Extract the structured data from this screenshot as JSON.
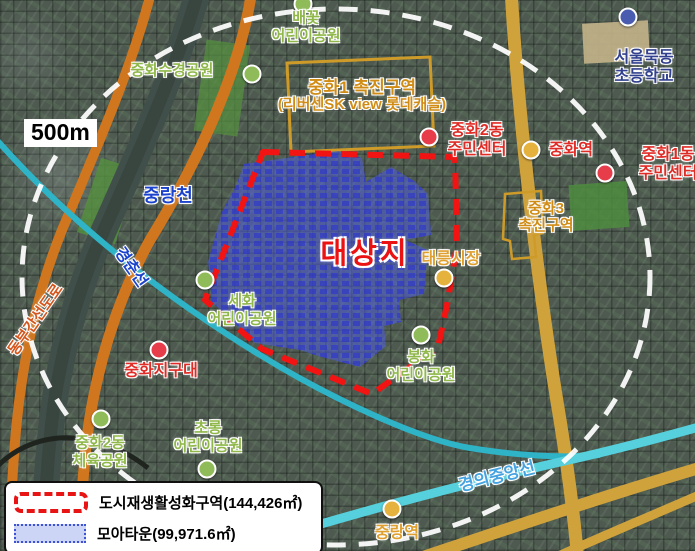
{
  "scale": {
    "label": "500m"
  },
  "site": {
    "label": "대상지"
  },
  "legend": {
    "items": [
      {
        "id": "regeneration-zone",
        "label": "도시재생활성화구역(144,426㎡)",
        "swatch": "red-dashed-outline"
      },
      {
        "id": "moa-town",
        "label": "모아타운(99,971.6㎡)",
        "swatch": "blue-filled"
      }
    ]
  },
  "zones": [
    {
      "id": "junghwa1-promotion-zone",
      "lines": [
        "중화1 촉진구역",
        "(리버센SK view 롯데캐슬)"
      ],
      "x": 362,
      "y": 96,
      "sizes": [
        17,
        15
      ]
    },
    {
      "id": "junghwa3-promotion-zone",
      "lines": [
        "중화3",
        "촉진구역"
      ],
      "x": 546,
      "y": 218,
      "sizes": [
        15,
        15
      ]
    }
  ],
  "markers": [
    {
      "id": "baekkot-childrens-park",
      "type": "park",
      "dotColor": "green",
      "dot": {
        "x": 303,
        "y": 4
      },
      "lines": [
        "배꽃",
        "어린이공원"
      ],
      "x": 306,
      "y": 27
    },
    {
      "id": "junghwa-sugyeong-park",
      "type": "park",
      "dotColor": "green",
      "dot": {
        "x": 252,
        "y": 74
      },
      "lines": [
        "중화수경공원"
      ],
      "x": 172,
      "y": 71
    },
    {
      "id": "seoul-mukdong-elementary-school",
      "type": "school",
      "dotColor": "blue",
      "dot": {
        "x": 628,
        "y": 17
      },
      "lines": [
        "서울묵동",
        "초등학교"
      ],
      "x": 644,
      "y": 68
    },
    {
      "id": "junghwa2dong-community-center",
      "type": "civic",
      "dotColor": "red",
      "dot": {
        "x": 429,
        "y": 137
      },
      "lines": [
        "중화2동",
        "주민센터"
      ],
      "x": 477,
      "y": 141
    },
    {
      "id": "junghwa-station",
      "type": "civic",
      "dotColor": "yellow",
      "dot": {
        "x": 531,
        "y": 150
      },
      "lines": [
        "중화역"
      ],
      "x": 571,
      "y": 151
    },
    {
      "id": "junghwa1dong-community-center",
      "type": "civic",
      "dotColor": "red",
      "dot": {
        "x": 605,
        "y": 173
      },
      "lines": [
        "중화1동",
        "주민센터"
      ],
      "x": 668,
      "y": 165
    },
    {
      "id": "taereung-market",
      "type": "market",
      "dotColor": "yellow",
      "dot": {
        "x": 444,
        "y": 278
      },
      "lines": [
        "태릉시장"
      ],
      "x": 451,
      "y": 260
    },
    {
      "id": "sehwa-childrens-park",
      "type": "park",
      "dotColor": "green",
      "dot": {
        "x": 205,
        "y": 280
      },
      "lines": [
        "세화",
        "어린이공원"
      ],
      "x": 242,
      "y": 310
    },
    {
      "id": "bonghwa-childrens-park",
      "type": "park",
      "dotColor": "green",
      "dot": {
        "x": 421,
        "y": 335
      },
      "lines": [
        "봉화",
        "어린이공원"
      ],
      "x": 421,
      "y": 366
    },
    {
      "id": "junghwa-police-substation",
      "type": "civic",
      "dotColor": "red",
      "dot": {
        "x": 159,
        "y": 350
      },
      "lines": [
        "중화지구대"
      ],
      "x": 161,
      "y": 372
    },
    {
      "id": "junghwa2dong-sports-park",
      "type": "park",
      "dotColor": "green",
      "dot": {
        "x": 101,
        "y": 419
      },
      "lines": [
        "중화2동",
        "체육공원"
      ],
      "x": 100,
      "y": 452
    },
    {
      "id": "chorong-childrens-park",
      "type": "park",
      "dotColor": "green",
      "dot": {
        "x": 207,
        "y": 469
      },
      "lines": [
        "초롱",
        "어린이공원"
      ],
      "x": 208,
      "y": 437
    },
    {
      "id": "jungnang-station",
      "type": "market",
      "dotColor": "yellow",
      "dot": {
        "x": 392,
        "y": 509
      },
      "lines": [
        "중랑역"
      ],
      "x": 397,
      "y": 534
    }
  ],
  "way_labels": [
    {
      "id": "jungnangcheon-stream",
      "type": "water",
      "text": "중랑천",
      "x": 168,
      "y": 196,
      "rot": 0,
      "size": 18
    },
    {
      "id": "gyeongchun-line",
      "type": "water",
      "text": "경춘선",
      "x": 130,
      "y": 268,
      "rot": 55,
      "size": 16
    },
    {
      "id": "dongbu-expressway",
      "type": "road",
      "text": "동부간선도로",
      "x": 36,
      "y": 320,
      "rot": -55,
      "size": 15
    },
    {
      "id": "gyeongui-jungang-line",
      "type": "rail",
      "text": "경의중앙선",
      "x": 497,
      "y": 477,
      "rot": -14,
      "size": 17
    }
  ],
  "colors": {
    "green": "#8fbb58",
    "red": "#e73c49",
    "yellow": "#e5b23e",
    "blue": "#4a5cb0",
    "boundary_red": "#f21313",
    "moatown_blue": "#2c35cf",
    "zone_orange": "#cf9b28",
    "radius_circle": "#ffffff"
  }
}
